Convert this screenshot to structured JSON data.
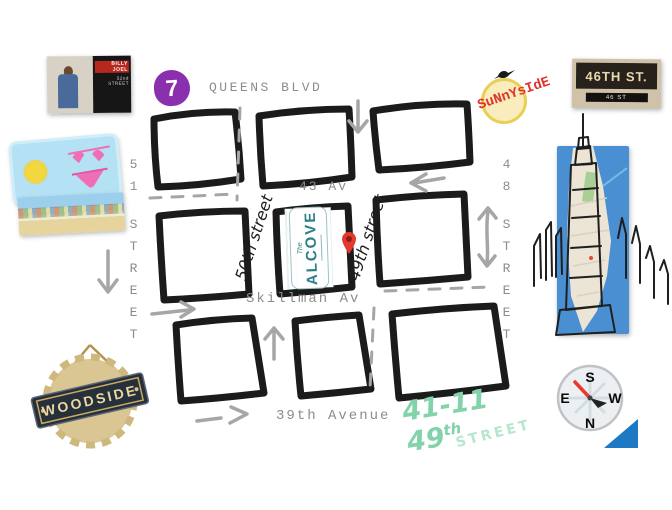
{
  "collage": {
    "album": {
      "artist": "BILLY JOEL",
      "title": "52nd STREET"
    },
    "subway_line": "7",
    "sunnyside": "SuNnYsIdE",
    "sign_46": {
      "main": "46TH ST.",
      "sub": "46 ST"
    },
    "woodside": "WOODSIDE"
  },
  "map": {
    "queens_blvd": "QUEENS BLVD",
    "av43": "43 Av",
    "skillman": "Skillman Av",
    "ave39": "39th Avenue",
    "st50": "50th street",
    "st49": "49th street",
    "st51": {
      "num": "51",
      "name": "STREET"
    },
    "st48": {
      "num": "48",
      "name": "STREET"
    },
    "venue": {
      "the": "The",
      "name": "ALCOVE"
    }
  },
  "address": {
    "num": "41-11 49",
    "suffix": "th",
    "street": "STREET"
  },
  "compass": {
    "n": "N",
    "s": "S",
    "e": "E",
    "w": "W"
  },
  "colors": {
    "subway_purple": "#8a2fae",
    "sunnyside_red": "#dc352c",
    "alcove_teal": "#2d7f86",
    "pin_red": "#e23a2f",
    "address_mint": "#82d3a9",
    "triangle_blue": "#1d79c4",
    "block_ink": "#1b1b1b",
    "street_gray": "#8c8c8c",
    "dash_gray": "#a6a6a6"
  }
}
